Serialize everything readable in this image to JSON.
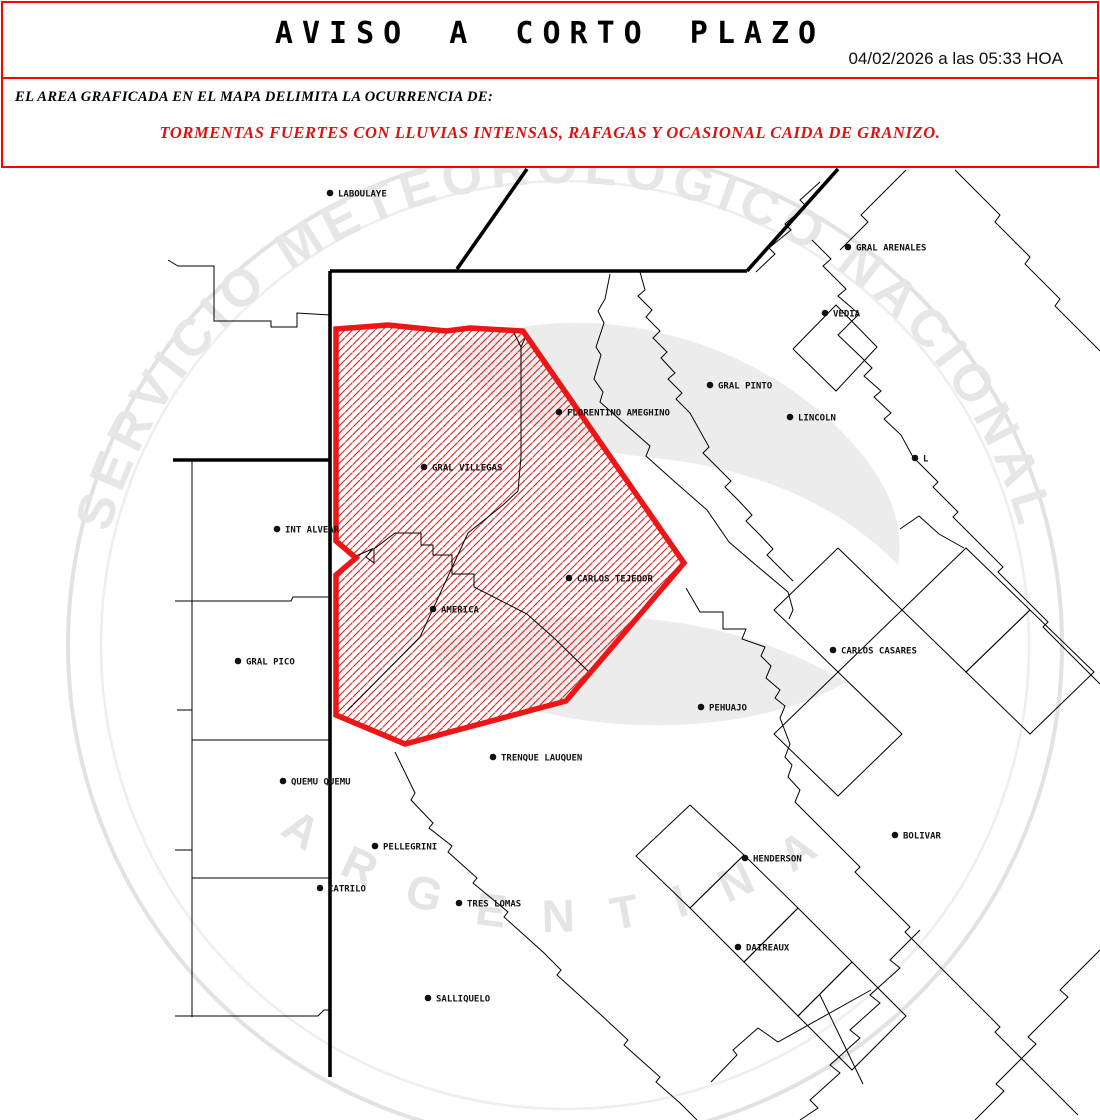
{
  "header": {
    "title": "AVISO A CORTO PLAZO",
    "datetime": "04/02/2026 a las 05:33 HOA"
  },
  "notice": {
    "intro": "EL AREA GRAFICADA EN EL MAPA DELIMITA LA OCURRENCIA DE:",
    "hazard": "TORMENTAS FUERTES CON LLUVIAS INTENSAS, RAFAGAS Y OCASIONAL CAIDA DE GRANIZO."
  },
  "colors": {
    "border_red": "#ff0000",
    "hazard_text_red": "#dd1111",
    "alert_outline": "#ed1515",
    "hatch_red": "#dd2020",
    "map_line": "#000000",
    "watermark_gray": "#e6e6e6"
  },
  "watermark": {
    "arc_text": "SERVICIO METEOROLÓGICO NACIONAL",
    "bottom_text": "ARGENTINA"
  },
  "map": {
    "labels": [
      {
        "text": "LABOULAYE",
        "x": 330,
        "y": 193
      },
      {
        "text": "GRAL ARENALES",
        "x": 848,
        "y": 247
      },
      {
        "text": "VEDIA",
        "x": 825,
        "y": 313
      },
      {
        "text": "GRAL PINTO",
        "x": 710,
        "y": 385
      },
      {
        "text": "LINCOLN",
        "x": 790,
        "y": 417
      },
      {
        "text": "FLORENTINO AMEGHINO",
        "x": 559,
        "y": 412
      },
      {
        "text": "L",
        "x": 915,
        "y": 458
      },
      {
        "text": "GRAL VILLEGAS",
        "x": 424,
        "y": 467
      },
      {
        "text": "INT ALVEAR",
        "x": 277,
        "y": 529
      },
      {
        "text": "CARLOS TEJEDOR",
        "x": 569,
        "y": 578
      },
      {
        "text": "AMERICA",
        "x": 433,
        "y": 609
      },
      {
        "text": "GRAL PICO",
        "x": 238,
        "y": 661
      },
      {
        "text": "CARLOS CASARES",
        "x": 833,
        "y": 650
      },
      {
        "text": "PEHUAJO",
        "x": 701,
        "y": 707
      },
      {
        "text": "TRENQUE LAUQUEN",
        "x": 493,
        "y": 757
      },
      {
        "text": "QUEMU QUEMU",
        "x": 283,
        "y": 781
      },
      {
        "text": "BOLIVAR",
        "x": 895,
        "y": 835
      },
      {
        "text": "PELLEGRINI",
        "x": 375,
        "y": 846
      },
      {
        "text": "HENDERSON",
        "x": 745,
        "y": 858
      },
      {
        "text": "CATRILO",
        "x": 320,
        "y": 888
      },
      {
        "text": "TRES LOMAS",
        "x": 459,
        "y": 903
      },
      {
        "text": "DAIREAUX",
        "x": 738,
        "y": 947
      },
      {
        "text": "SALLIQUELO",
        "x": 428,
        "y": 998
      }
    ],
    "alert_polygon": [
      [
        336,
        329
      ],
      [
        388,
        325
      ],
      [
        446,
        331
      ],
      [
        470,
        328
      ],
      [
        523,
        331
      ],
      [
        684,
        563
      ],
      [
        566,
        701
      ],
      [
        405,
        744
      ],
      [
        336,
        715
      ],
      [
        336,
        575
      ],
      [
        356,
        558
      ],
      [
        336,
        541
      ]
    ],
    "thick_lines": [
      [
        [
          330,
          271
        ],
        [
          747,
          271
        ]
      ],
      [
        [
          747,
          271
        ],
        [
          838,
          169
        ]
      ],
      [
        [
          457,
          269
        ],
        [
          527,
          169
        ]
      ],
      [
        [
          330,
          271
        ],
        [
          330,
          1077
        ]
      ],
      [
        [
          173,
          460
        ],
        [
          330,
          460
        ]
      ]
    ],
    "thin_lines": [
      [
        [
          168,
          260
        ],
        [
          178,
          266
        ],
        [
          214,
          266
        ],
        [
          214,
          321
        ],
        [
          271,
          321
        ],
        [
          271,
          327
        ],
        [
          297,
          327
        ],
        [
          297,
          313
        ],
        [
          330,
          315
        ]
      ],
      [
        [
          192,
          460
        ],
        [
          192,
          1017
        ]
      ],
      [
        [
          175,
          601
        ],
        [
          291,
          601
        ],
        [
          293,
          597
        ],
        [
          330,
          597
        ]
      ],
      [
        [
          192,
          740
        ],
        [
          330,
          740
        ]
      ],
      [
        [
          192,
          878
        ],
        [
          330,
          878
        ]
      ],
      [
        [
          175,
          1016
        ],
        [
          318,
          1016
        ],
        [
          324,
          1010
        ],
        [
          330,
          1010
        ]
      ],
      [
        [
          177,
          710
        ],
        [
          192,
          710
        ]
      ],
      [
        [
          175,
          850
        ],
        [
          192,
          850
        ]
      ],
      [
        [
          610,
          274
        ],
        [
          605,
          299
        ],
        [
          598,
          311
        ],
        [
          604,
          323
        ],
        [
          596,
          347
        ],
        [
          601,
          355
        ],
        [
          594,
          379
        ],
        [
          603,
          392
        ],
        [
          600,
          402
        ],
        [
          625,
          424
        ],
        [
          650,
          446
        ],
        [
          646,
          456
        ],
        [
          675,
          482
        ],
        [
          707,
          510
        ],
        [
          729,
          542
        ],
        [
          757,
          566
        ],
        [
          788,
          592
        ],
        [
          793,
          610
        ],
        [
          789,
          619
        ]
      ],
      [
        [
          514,
          333
        ],
        [
          521,
          347
        ],
        [
          527,
          334
        ]
      ],
      [
        [
          521,
          347
        ],
        [
          521,
          457
        ],
        [
          518,
          491
        ],
        [
          503,
          505
        ],
        [
          468,
          533
        ],
        [
          420,
          637
        ],
        [
          348,
          710
        ]
      ],
      [
        [
          356,
          556
        ],
        [
          372,
          549
        ],
        [
          366,
          557
        ],
        [
          374,
          563
        ],
        [
          374,
          549
        ],
        [
          395,
          533
        ],
        [
          421,
          533
        ],
        [
          421,
          545
        ],
        [
          433,
          545
        ],
        [
          433,
          555
        ],
        [
          452,
          555
        ],
        [
          452,
          574
        ],
        [
          474,
          574
        ],
        [
          474,
          587
        ],
        [
          527,
          614
        ],
        [
          554,
          638
        ],
        [
          590,
          673
        ]
      ],
      [
        [
          686,
          588
        ],
        [
          700,
          612
        ],
        [
          723,
          612
        ],
        [
          723,
          629
        ],
        [
          746,
          629
        ],
        [
          742,
          639
        ],
        [
          765,
          647
        ],
        [
          761,
          656
        ],
        [
          771,
          666
        ],
        [
          766,
          678
        ],
        [
          780,
          690
        ],
        [
          775,
          698
        ],
        [
          785,
          706
        ],
        [
          780,
          718
        ],
        [
          790,
          744
        ],
        [
          785,
          757
        ],
        [
          792,
          765
        ],
        [
          788,
          777
        ],
        [
          800,
          790
        ],
        [
          795,
          802
        ],
        [
          807,
          814
        ],
        [
          860,
          867
        ],
        [
          855,
          872
        ],
        [
          910,
          927
        ],
        [
          905,
          932
        ],
        [
          955,
          982
        ],
        [
          1000,
          1027
        ],
        [
          995,
          1032
        ],
        [
          1045,
          1082
        ],
        [
          1078,
          1115
        ]
      ],
      [
        [
          395,
          752
        ],
        [
          415,
          793
        ],
        [
          411,
          800
        ],
        [
          433,
          823
        ],
        [
          429,
          828
        ],
        [
          452,
          846
        ],
        [
          448,
          852
        ],
        [
          477,
          878
        ],
        [
          473,
          883
        ],
        [
          508,
          912
        ],
        [
          504,
          917
        ],
        [
          543,
          952
        ],
        [
          561,
          970
        ],
        [
          557,
          975
        ],
        [
          600,
          1014
        ],
        [
          628,
          1040
        ],
        [
          624,
          1045
        ],
        [
          660,
          1077
        ],
        [
          656,
          1082
        ],
        [
          680,
          1103
        ],
        [
          697,
          1120
        ]
      ],
      [
        [
          711,
          1082
        ],
        [
          737,
          1055
        ],
        [
          733,
          1050
        ],
        [
          758,
          1028
        ],
        [
          778,
          1042
        ],
        [
          871,
          990
        ]
      ],
      [
        [
          820,
          995
        ],
        [
          863,
          1084
        ]
      ],
      [
        [
          812,
          240
        ],
        [
          831,
          259
        ],
        [
          823,
          266
        ],
        [
          846,
          289
        ],
        [
          838,
          296
        ],
        [
          859,
          314
        ],
        [
          851,
          322
        ],
        [
          838,
          335
        ],
        [
          861,
          357
        ],
        [
          872,
          368
        ],
        [
          864,
          376
        ],
        [
          881,
          391
        ],
        [
          874,
          397
        ],
        [
          891,
          413
        ],
        [
          884,
          419
        ],
        [
          901,
          435
        ],
        [
          913,
          457
        ]
      ],
      [
        [
          793,
          349
        ],
        [
          836,
          305
        ],
        [
          877,
          347
        ],
        [
          836,
          391
        ],
        [
          793,
          349
        ]
      ],
      [
        [
          756,
          272
        ],
        [
          775,
          254
        ],
        [
          769,
          248
        ],
        [
          791,
          230
        ],
        [
          785,
          224
        ],
        [
          806,
          206
        ],
        [
          800,
          200
        ],
        [
          820,
          182
        ]
      ],
      [
        [
          913,
          457
        ],
        [
          938,
          482
        ],
        [
          933,
          487
        ],
        [
          958,
          512
        ],
        [
          953,
          517
        ],
        [
          978,
          542
        ],
        [
          1003,
          567
        ],
        [
          998,
          572
        ],
        [
          1023,
          597
        ],
        [
          1048,
          622
        ],
        [
          1043,
          627
        ],
        [
          1068,
          652
        ],
        [
          1093,
          677
        ],
        [
          1100,
          684
        ]
      ],
      [
        [
          906,
          170
        ],
        [
          861,
          215
        ],
        [
          868,
          222
        ],
        [
          840,
          250
        ]
      ],
      [
        [
          955,
          170
        ],
        [
          1000,
          215
        ],
        [
          995,
          222
        ],
        [
          1030,
          257
        ],
        [
          1025,
          264
        ],
        [
          1060,
          299
        ],
        [
          1055,
          306
        ],
        [
          1090,
          341
        ],
        [
          1100,
          351
        ]
      ],
      [
        [
          900,
          529
        ],
        [
          919,
          516
        ],
        [
          939,
          534
        ],
        [
          964,
          548
        ]
      ],
      [
        [
          640,
          272
        ],
        [
          645,
          290
        ],
        [
          638,
          296
        ],
        [
          652,
          310
        ],
        [
          646,
          317
        ],
        [
          660,
          331
        ],
        [
          653,
          338
        ],
        [
          667,
          352
        ],
        [
          661,
          358
        ],
        [
          675,
          373
        ],
        [
          668,
          379
        ],
        [
          682,
          393
        ],
        [
          676,
          399
        ],
        [
          690,
          413
        ],
        [
          709,
          447
        ],
        [
          703,
          453
        ],
        [
          717,
          467
        ],
        [
          731,
          481
        ],
        [
          725,
          487
        ],
        [
          739,
          501
        ],
        [
          752,
          515
        ],
        [
          746,
          521
        ],
        [
          760,
          535
        ],
        [
          773,
          549
        ],
        [
          767,
          555
        ],
        [
          781,
          569
        ],
        [
          793,
          581
        ]
      ],
      [
        [
          690,
          805
        ],
        [
          744,
          855
        ],
        [
          690,
          908
        ],
        [
          636,
          856
        ],
        [
          690,
          805
        ]
      ],
      [
        [
          744,
          855
        ],
        [
          798,
          908
        ],
        [
          744,
          962
        ],
        [
          690,
          908
        ],
        [
          744,
          855
        ]
      ],
      [
        [
          798,
          908
        ],
        [
          852,
          962
        ],
        [
          798,
          1016
        ],
        [
          744,
          962
        ],
        [
          798,
          908
        ]
      ],
      [
        [
          852,
          962
        ],
        [
          906,
          1016
        ],
        [
          852,
          1070
        ],
        [
          798,
          1016
        ],
        [
          852,
          962
        ]
      ],
      [
        [
          838,
          548
        ],
        [
          902,
          610
        ],
        [
          838,
          672
        ],
        [
          774,
          610
        ],
        [
          838,
          548
        ]
      ],
      [
        [
          902,
          610
        ],
        [
          966,
          548
        ],
        [
          1030,
          610
        ],
        [
          966,
          672
        ],
        [
          902,
          610
        ]
      ],
      [
        [
          1030,
          610
        ],
        [
          1094,
          672
        ],
        [
          1030,
          734
        ],
        [
          966,
          672
        ],
        [
          1030,
          610
        ]
      ],
      [
        [
          838,
          672
        ],
        [
          902,
          734
        ],
        [
          838,
          796
        ],
        [
          774,
          734
        ],
        [
          838,
          672
        ]
      ],
      [
        [
          920,
          930
        ],
        [
          890,
          960
        ],
        [
          900,
          968
        ],
        [
          870,
          995
        ],
        [
          880,
          1003
        ],
        [
          850,
          1030
        ],
        [
          860,
          1038
        ],
        [
          830,
          1065
        ],
        [
          840,
          1073
        ],
        [
          810,
          1100
        ],
        [
          818,
          1108
        ],
        [
          800,
          1120
        ]
      ],
      [
        [
          1100,
          950
        ],
        [
          1060,
          990
        ],
        [
          1068,
          997
        ],
        [
          1028,
          1037
        ],
        [
          1036,
          1044
        ],
        [
          996,
          1084
        ],
        [
          1004,
          1091
        ],
        [
          975,
          1120
        ]
      ]
    ]
  }
}
